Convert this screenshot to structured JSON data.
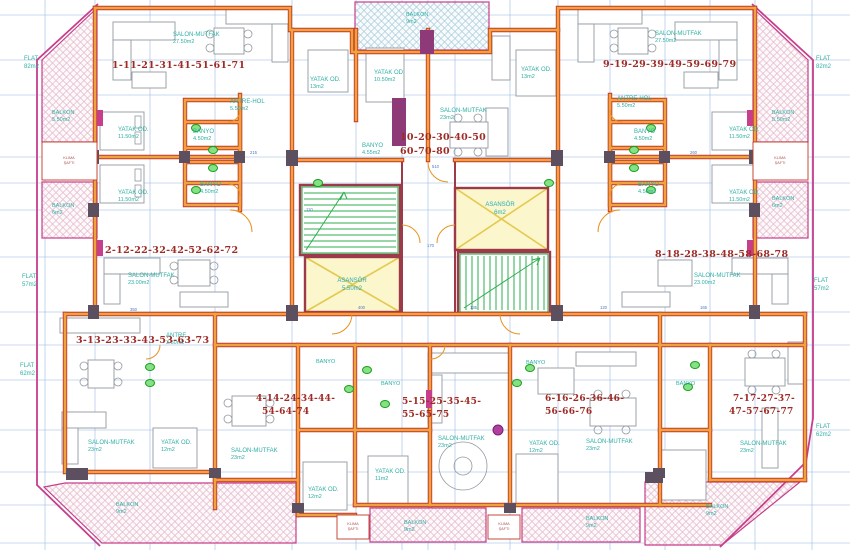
{
  "meta": {
    "type": "architectural floor plan",
    "units": "m2"
  },
  "colors": {
    "wall_orange": "#F0A23C",
    "wall_red": "#C0392B",
    "core_maroon": "#9C3A4A",
    "balcony_magenta": "#C73E8C",
    "grid_blue": "#7FA8DC",
    "label_teal": "#2FAFA5",
    "apartment_red": "#9E2B25",
    "fixture_green": "#17A017",
    "stair_green": "#2FAF4F",
    "elevator_yellow": "#FBF6CB",
    "column_dark": "#5C4F60"
  },
  "apartments": [
    {
      "line1": "1-11-21-31-41-51-61-71",
      "line2": ""
    },
    {
      "line1": "2-12-22-32-42-52-62-72",
      "line2": ""
    },
    {
      "line1": "3-13-23-33-43-53-63-73",
      "line2": ""
    },
    {
      "line1": "4-14-24-34-44-",
      "line2": "54-64-74"
    },
    {
      "line1": "5-15-25-35-45-",
      "line2": "55-65-75"
    },
    {
      "line1": "6-16-26-36-46-",
      "line2": "56-66-76"
    },
    {
      "line1": "7-17-27-37-",
      "line2": "47-57-67-77"
    },
    {
      "line1": "8-18-28-38-48-58-68-78",
      "line2": ""
    },
    {
      "line1": "9-19-29-39-49-59-69-79",
      "line2": ""
    },
    {
      "line1": "10-20-30-40-50",
      "line2": "60-70-80"
    }
  ],
  "rooms": [
    {
      "n": "SALON-MUTFAK",
      "a": "27.50m2"
    },
    {
      "n": "YATAK OD.",
      "a": "11.50m2"
    },
    {
      "n": "ANTRE-HOL",
      "a": "5.50m2"
    },
    {
      "n": "BANYO",
      "a": "4.50m2"
    },
    {
      "n": "YATAK OD.",
      "a": "11.50m2"
    },
    {
      "n": "BANYO",
      "a": "4.50m2"
    },
    {
      "n": "SALON-MUTFAK",
      "a": "23.00m2"
    },
    {
      "n": "YATAK OD.",
      "a": "13m2"
    },
    {
      "n": "YATAK OD.",
      "a": "10.50m2"
    },
    {
      "n": "YATAK OD.",
      "a": "13m2"
    },
    {
      "n": "SALON-MUTFAK",
      "a": "23m2"
    },
    {
      "n": "BANYO",
      "a": "4.55m2"
    },
    {
      "n": "SALON-MUTFAK",
      "a": "27.50m2"
    },
    {
      "n": "ANTRE-HOL",
      "a": "5.50m2"
    },
    {
      "n": "YATAK OD.",
      "a": "11.50m2"
    },
    {
      "n": "BANYO",
      "a": "4.50m2"
    },
    {
      "n": "YATAK OD.",
      "a": "11.50m2"
    },
    {
      "n": "BANYO",
      "a": "4.50m2"
    },
    {
      "n": "SALON-MUTFAK",
      "a": "23.00m2"
    },
    {
      "n": "ANTRE",
      "a": "3.50m2"
    },
    {
      "n": "SALON-MUTFAK",
      "a": "23m2"
    },
    {
      "n": "YATAK OD.",
      "a": "12m2"
    },
    {
      "n": "SALON-MUTFAK",
      "a": "23m2"
    },
    {
      "n": "YATAK OD.",
      "a": "12m2"
    },
    {
      "n": "YATAK OD.",
      "a": "11m2"
    },
    {
      "n": "SALON-MUTFAK",
      "a": "23m2"
    },
    {
      "n": "YATAK OD.",
      "a": "12m2"
    },
    {
      "n": "SALON-MUTFAK",
      "a": "23m2"
    },
    {
      "n": "SALON-MUTFAK",
      "a": "23m2"
    },
    {
      "n": "BANYO",
      "a": ""
    },
    {
      "n": "BANYO",
      "a": ""
    },
    {
      "n": "BANYO",
      "a": ""
    },
    {
      "n": "BANYO",
      "a": ""
    }
  ],
  "flats": [
    {
      "n": "FLAT",
      "a": "82m2"
    },
    {
      "n": "FLAT",
      "a": "57m2"
    },
    {
      "n": "FLAT",
      "a": "62m2"
    },
    {
      "n": "FLAT",
      "a": "82m2"
    },
    {
      "n": "FLAT",
      "a": "57m2"
    },
    {
      "n": "FLAT",
      "a": "62m2"
    }
  ],
  "balconies": [
    {
      "n": "BALKON",
      "a": "9m2"
    },
    {
      "n": "BALKON",
      "a": "5.50m2"
    },
    {
      "n": "BALKON",
      "a": "6m2"
    },
    {
      "n": "BALKON",
      "a": "5.50m2"
    },
    {
      "n": "BALKON",
      "a": "6m2"
    },
    {
      "n": "BALKON",
      "a": "9m2"
    },
    {
      "n": "BALKON",
      "a": "9m2"
    },
    {
      "n": "BALKON",
      "a": "9m2"
    },
    {
      "n": "BALKON",
      "a": "9m2"
    }
  ],
  "elevators": [
    {
      "n": "ASANSÖR",
      "a": "6m2"
    },
    {
      "n": "ASANSÖR",
      "a": "5.50m2"
    }
  ],
  "shafts": [
    {
      "l1": "KLIMA",
      "l2": "ŞAFTI"
    },
    {
      "l1": "KLIMA",
      "l2": "ŞAFTI"
    },
    {
      "l1": "KLIMA",
      "l2": "ŞAFTI"
    },
    {
      "l1": "KLIMA",
      "l2": "ŞAFTI"
    }
  ],
  "dims": [
    "170",
    "110",
    "400",
    "135",
    "350",
    "120",
    "165",
    "215",
    "260",
    "510"
  ]
}
